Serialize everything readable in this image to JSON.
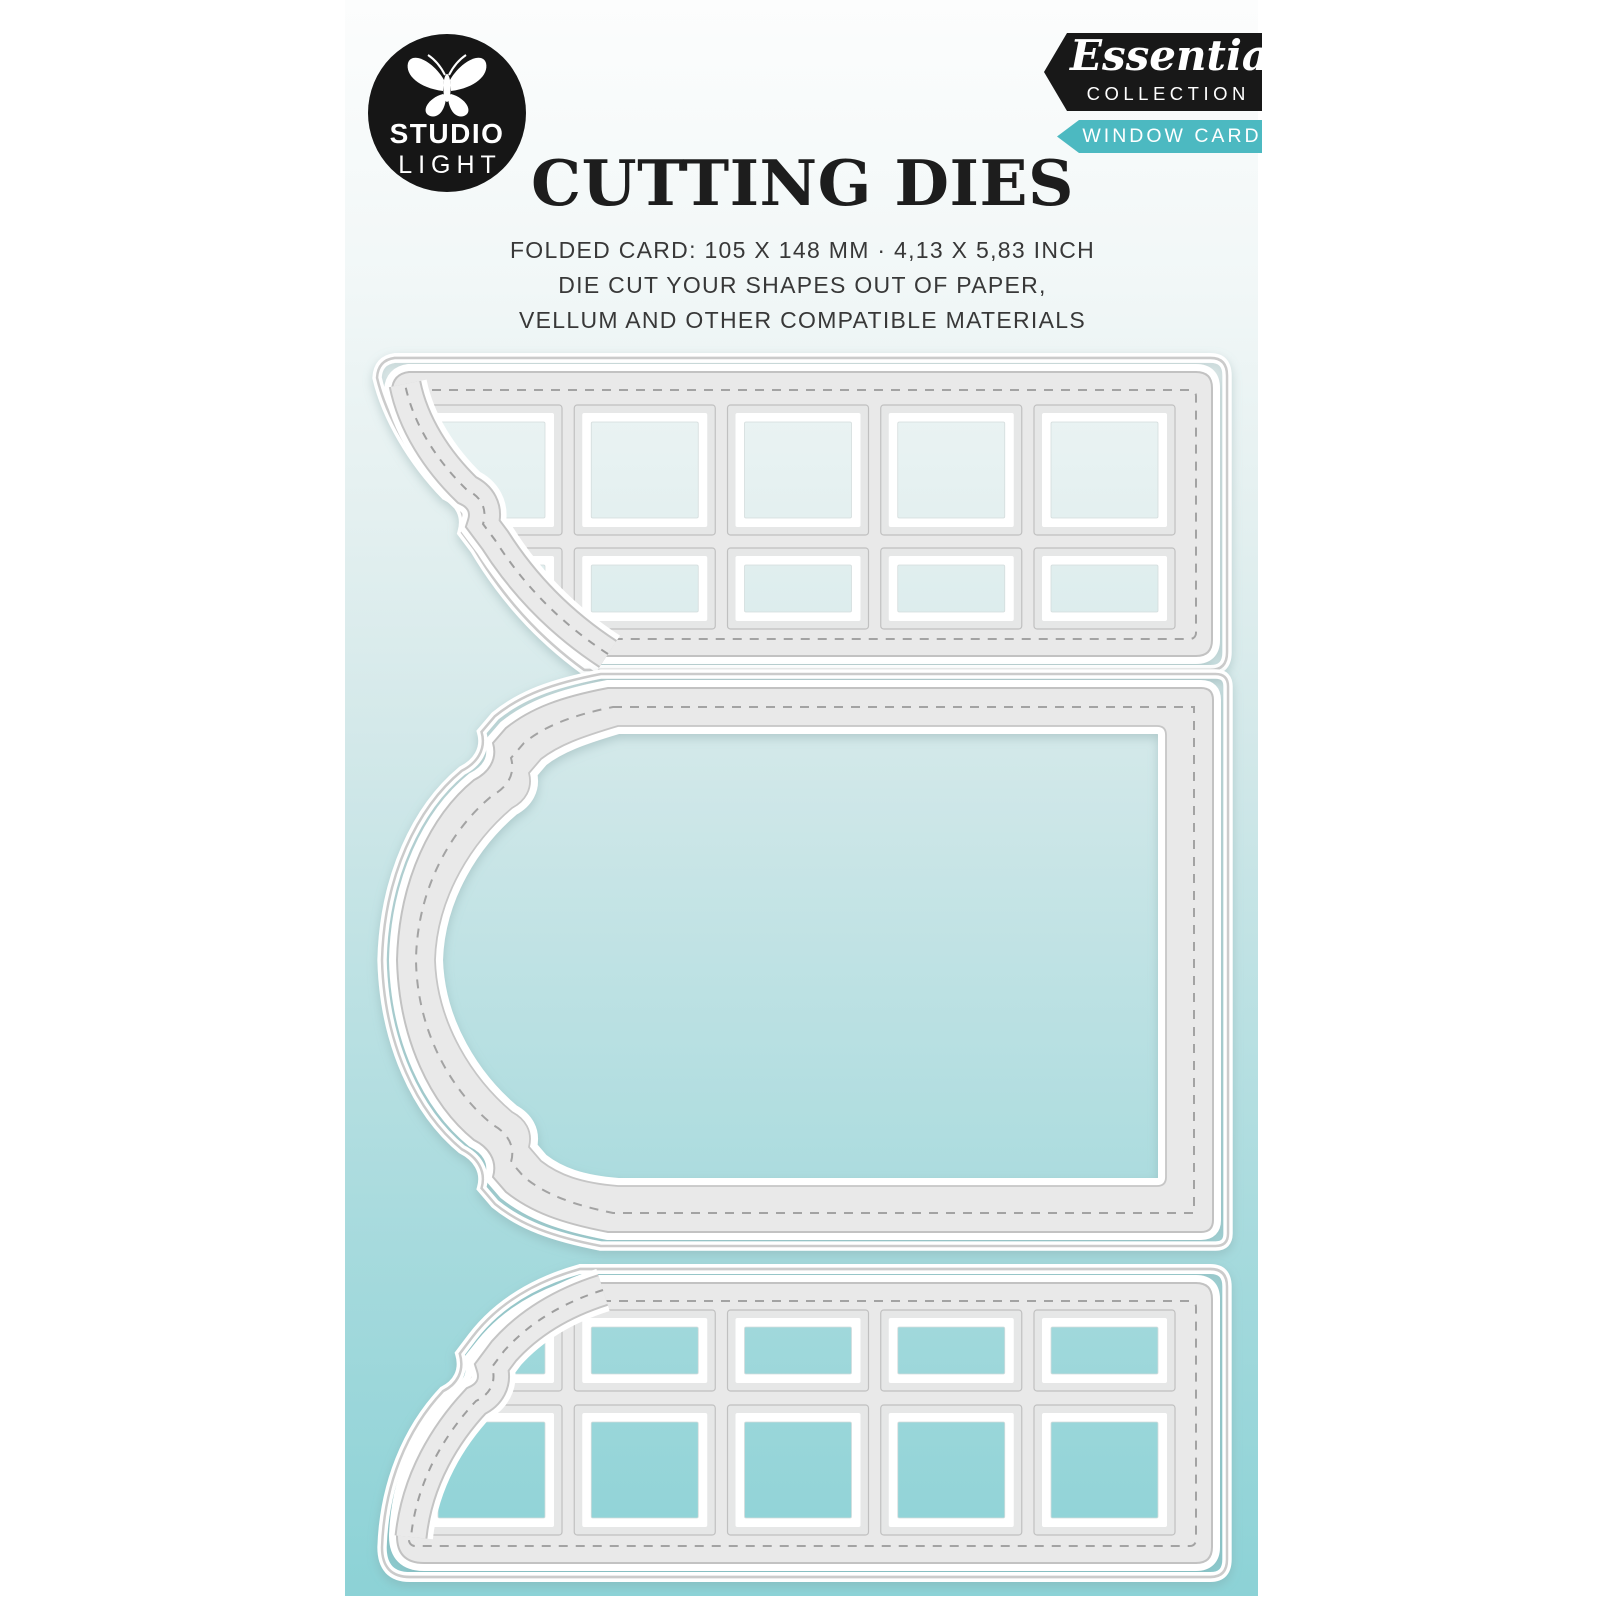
{
  "page": {
    "background": "#ffffff"
  },
  "brand_logo": {
    "line1": "STUDIO",
    "line2": "LIGHT",
    "icon": "butterfly",
    "bg": "#161616"
  },
  "collection_banner": {
    "script_text": "Essentials",
    "caps_text": "COLLECTION",
    "bg": "#181818",
    "text_color": "#ffffff"
  },
  "product_banner": {
    "text": "WINDOW CARD",
    "bg": "#4cb9c1",
    "text_color": "#ffffff"
  },
  "heading": {
    "title": "CUTTING DIES"
  },
  "description": {
    "line1": "FOLDED CARD: 105 X 148 MM · 4,13 X 5,83 INCH",
    "line2": "DIE CUT YOUR SHAPES OUT OF PAPER,",
    "line3": "VELLUM AND OTHER COMPATIBLE MATERIALS"
  },
  "illustration": {
    "gradient_top": "#fcfdfd",
    "gradient_bottom": "#8cd2d6",
    "die_color": "#e9e9e9",
    "outline_color": "#c2c2c2",
    "stitch_color": "#a3a3a3",
    "dies": [
      {
        "name": "top-window-grid-die",
        "columns": 5,
        "rows": 2
      },
      {
        "name": "bracket-frame-die",
        "columns": 0,
        "rows": 0
      },
      {
        "name": "bottom-window-grid-die",
        "columns": 5,
        "rows": 2
      }
    ]
  }
}
